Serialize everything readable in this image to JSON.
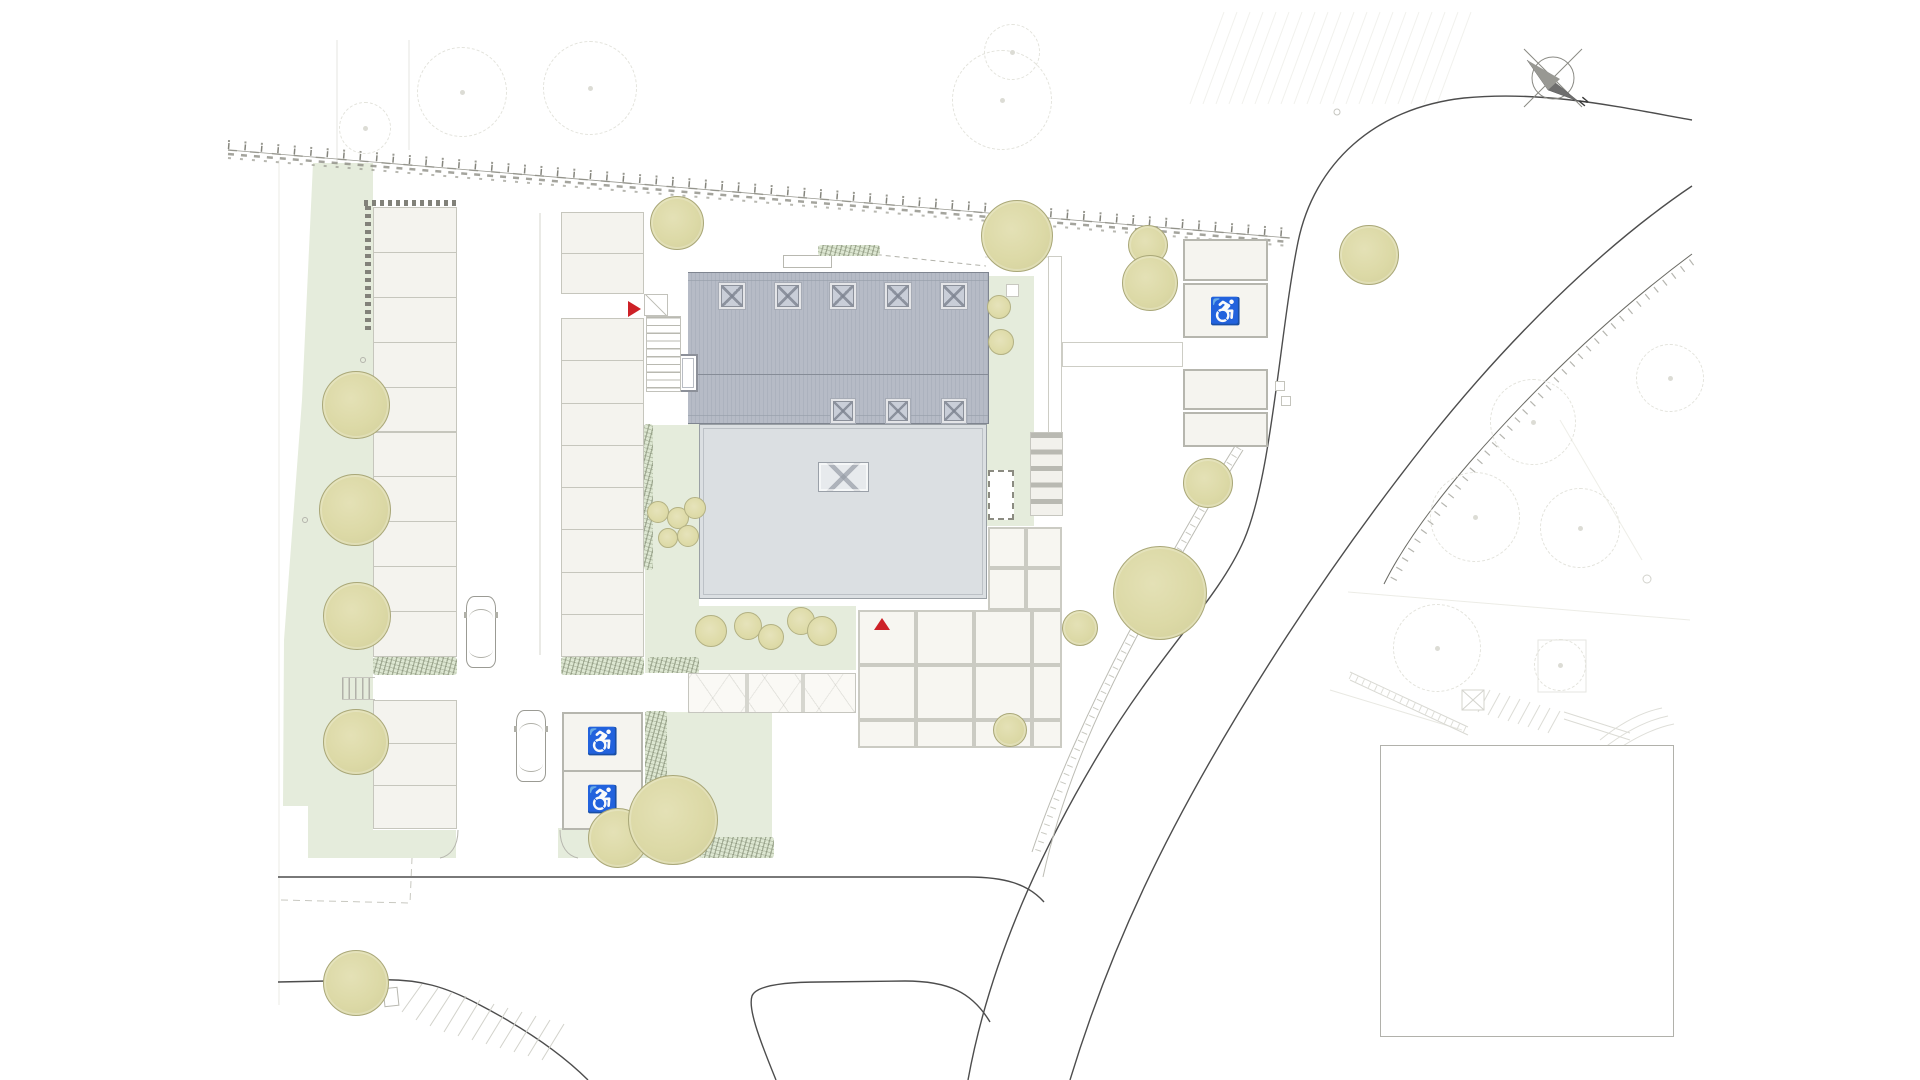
{
  "compass": {
    "north_label": "N"
  },
  "symbols": {
    "accessible_parking": "♿"
  },
  "palette": {
    "lawn_green": "#e5ecdc",
    "tree_canopy": "#dcd9a6",
    "roof_dark": "#b6bbc6",
    "roof_light": "#dbdfe2",
    "paving": "#f4f3ee",
    "road_line": "#4d4d4d",
    "accent_red": "#cd2127"
  },
  "markers": [
    {
      "id": "section-marker-west",
      "x": 628,
      "y": 301,
      "dir": "right"
    },
    {
      "id": "section-marker-south",
      "x": 874,
      "y": 618,
      "dir": "up"
    }
  ],
  "landscape": {
    "trees": [
      {
        "x": 356,
        "y": 405,
        "r": 34
      },
      {
        "x": 355,
        "y": 510,
        "r": 36
      },
      {
        "x": 357,
        "y": 616,
        "r": 34
      },
      {
        "x": 356,
        "y": 742,
        "r": 33
      },
      {
        "x": 356,
        "y": 983,
        "r": 33
      },
      {
        "x": 677,
        "y": 223,
        "r": 27
      },
      {
        "x": 1017,
        "y": 236,
        "r": 36
      },
      {
        "x": 1148,
        "y": 245,
        "r": 20
      },
      {
        "x": 1150,
        "y": 283,
        "r": 28
      },
      {
        "x": 1369,
        "y": 255,
        "r": 30
      },
      {
        "x": 1208,
        "y": 483,
        "r": 25
      },
      {
        "x": 1160,
        "y": 593,
        "r": 47
      },
      {
        "x": 1080,
        "y": 628,
        "r": 18
      },
      {
        "x": 1010,
        "y": 730,
        "r": 17
      },
      {
        "x": 618,
        "y": 838,
        "r": 30
      },
      {
        "x": 673,
        "y": 820,
        "r": 45
      }
    ],
    "shrubs": [
      {
        "x": 999,
        "y": 307,
        "r": 12
      },
      {
        "x": 1001,
        "y": 342,
        "r": 13
      },
      {
        "x": 711,
        "y": 631,
        "r": 16
      },
      {
        "x": 748,
        "y": 626,
        "r": 14
      },
      {
        "x": 771,
        "y": 637,
        "r": 13
      },
      {
        "x": 801,
        "y": 621,
        "r": 14
      },
      {
        "x": 822,
        "y": 631,
        "r": 15
      },
      {
        "x": 658,
        "y": 512,
        "r": 11
      },
      {
        "x": 678,
        "y": 518,
        "r": 11
      },
      {
        "x": 695,
        "y": 508,
        "r": 11
      },
      {
        "x": 668,
        "y": 538,
        "r": 10
      },
      {
        "x": 688,
        "y": 536,
        "r": 11
      }
    ],
    "faint_trees": [
      {
        "x": 462,
        "y": 92,
        "r": 45
      },
      {
        "x": 590,
        "y": 88,
        "r": 47
      },
      {
        "x": 1002,
        "y": 100,
        "r": 50
      },
      {
        "x": 1012,
        "y": 52,
        "r": 28
      },
      {
        "x": 365,
        "y": 128,
        "r": 26
      },
      {
        "x": 1533,
        "y": 422,
        "r": 43
      },
      {
        "x": 1475,
        "y": 517,
        "r": 45
      },
      {
        "x": 1580,
        "y": 528,
        "r": 40
      },
      {
        "x": 1670,
        "y": 378,
        "r": 34
      },
      {
        "x": 1437,
        "y": 648,
        "r": 44
      },
      {
        "x": 1560,
        "y": 665,
        "r": 26
      }
    ]
  },
  "building": {
    "skylights": [
      {
        "x": 721,
        "y": 285,
        "s": 22
      },
      {
        "x": 777,
        "y": 285,
        "s": 22
      },
      {
        "x": 832,
        "y": 285,
        "s": 22
      },
      {
        "x": 887,
        "y": 285,
        "s": 22
      },
      {
        "x": 943,
        "y": 285,
        "s": 22
      },
      {
        "x": 833,
        "y": 401,
        "s": 20
      },
      {
        "x": 888,
        "y": 401,
        "s": 20
      },
      {
        "x": 944,
        "y": 401,
        "s": 20
      }
    ],
    "roof_hatch": {
      "x": 818,
      "y": 462,
      "w": 51,
      "h": 30
    }
  },
  "parking": {
    "left_column": {
      "x": 373,
      "w": 84,
      "groups": [
        {
          "top": 207,
          "rows": 10,
          "row_h": 44.9
        },
        {
          "top": 700,
          "rows": 3,
          "row_h": 42.7
        }
      ]
    },
    "right_column": {
      "x": 561,
      "w": 83,
      "groups": [
        {
          "top": 212,
          "rows": 2,
          "row_h": 40.5
        },
        {
          "top": 318,
          "rows": 8,
          "row_h": 42.25
        }
      ]
    },
    "accessible_column": {
      "x": 562,
      "w": 81,
      "top": 712,
      "rows": 2,
      "row_h": 58
    },
    "garage_row": {
      "x": 1183,
      "w": 85,
      "spaces": [
        [
          239,
          281
        ],
        [
          283,
          338
        ],
        [
          369,
          410
        ],
        [
          412,
          447
        ]
      ],
      "accessible_index": 1
    }
  },
  "terrace_grids": [
    {
      "cols": [
        988,
        1026,
        1062
      ],
      "rows": [
        527,
        568,
        610
      ]
    },
    {
      "cols": [
        858,
        916,
        974,
        1032,
        1062
      ],
      "rows": [
        610,
        665,
        720,
        748
      ]
    }
  ],
  "cars": [
    {
      "x": 466,
      "y": 596
    },
    {
      "x": 516,
      "y": 710
    }
  ]
}
